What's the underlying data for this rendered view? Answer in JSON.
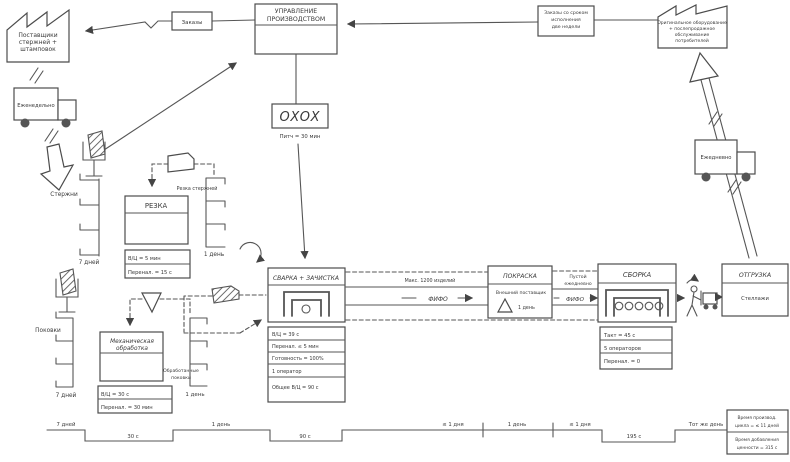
{
  "map": {
    "supplier": {
      "name": [
        "Поставщики",
        "стержней +",
        "штамповок"
      ],
      "shipment": "Еженедельно"
    },
    "customer": {
      "name": [
        "Оригинальное оборудование",
        "+ послепродажное",
        "обслуживание",
        "потребителей"
      ],
      "shipment": "Ежедневно"
    },
    "control": {
      "title": [
        "УПРАВЛЕНИЕ",
        "ПРОИЗВОДСТВОМ"
      ],
      "orders": "Заказы",
      "customer_orders": [
        "Заказы со сроком",
        "исполнения",
        "две недели"
      ],
      "heijunka": "OXOX",
      "pitch": "Питч = 30 мин"
    },
    "inventory": {
      "rods": "Стержни",
      "rods_days": "7 дней",
      "forgings": "Поковки",
      "forgings_days": "7 дней",
      "cut_rods": "Резка стержней",
      "cut_rods_days": "1 день",
      "machined": [
        "Обработанные",
        "поковки"
      ],
      "machined_days": "1 день",
      "paint_days": "1 день"
    },
    "processes": {
      "cutting": {
        "title": "РЕЗКА",
        "rows": [
          "В/Ц = 5 мин",
          "Перенал. = 15 с"
        ]
      },
      "machining": {
        "title": [
          "Механическая",
          "обработка"
        ],
        "rows": [
          "В/Ц = 30 с",
          "Перенал. = 30 мин"
        ]
      },
      "welding": {
        "title": "СВАРКА + ЗАЧИСТКА",
        "rows": [
          "В/Ц = 39 с",
          "Перенал. ≤ 5 мин",
          "Готовность = 100%",
          "1 оператор",
          "Общее В/Ц = 90 с"
        ]
      },
      "painting": {
        "title": "ПОКРАСКА",
        "note": "Внешний поставщик"
      },
      "assembly": {
        "title": "СБОРКА",
        "rows": [
          "Такт = 45 с",
          "5 операторов",
          "Перенал. = 0"
        ]
      },
      "shipping": {
        "title": "ОТГРУЗКА",
        "note": "Стеллажи"
      }
    },
    "fifo1": {
      "cap": "Макс. 1200 изделий",
      "label": "ФИФО"
    },
    "fifo2": {
      "cap": [
        "Пустой",
        "ежедневно"
      ],
      "label": "ФИФО"
    },
    "timeline": {
      "steps": [
        "7 дней",
        "30 с",
        "1 день",
        "90 с",
        "≤ 1 дня",
        "1 день",
        "≤ 1 дня",
        "195 с",
        "Тот же день"
      ],
      "summary": [
        "Время производ.",
        "цикла = ≤ 11 дней",
        "Время добавления",
        "ценности = 315 с"
      ]
    }
  }
}
